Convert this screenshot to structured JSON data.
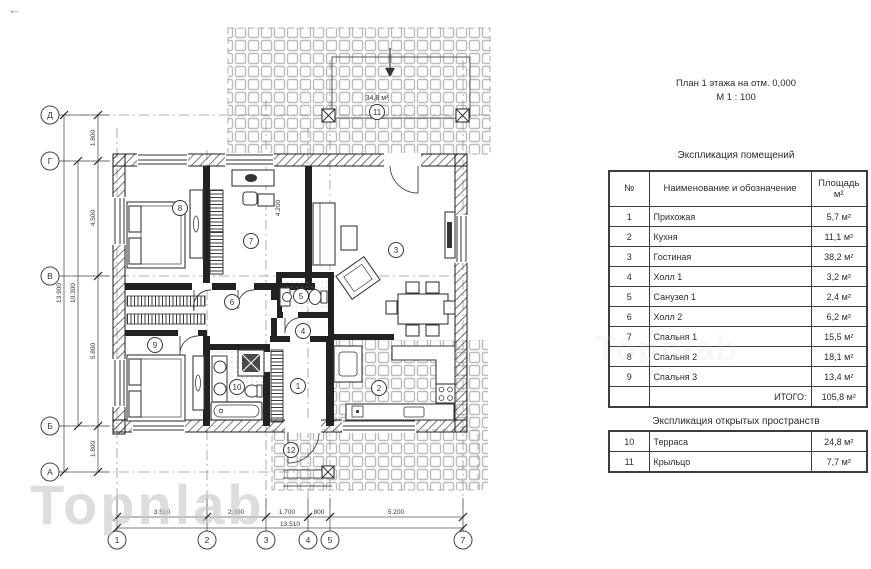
{
  "header": {
    "back_glyph": "←"
  },
  "watermark": {
    "text": "Topnlab"
  },
  "plan": {
    "title": "План 1 этажа на отм. 0,000",
    "scale": "М 1 : 100",
    "terrace_area": "34,8 м²",
    "axis_rows": [
      "Д",
      "Г",
      "В",
      "Б",
      "А"
    ],
    "axis_cols": [
      "1",
      "2",
      "3",
      "4",
      "5",
      "7"
    ],
    "dims_left": [
      "1.800",
      "4.500",
      "5.800",
      "1.800"
    ],
    "dim_left_total": "13.900",
    "dim_left_inner": "10.300",
    "dims_bottom": [
      "3.510",
      "2.300",
      "1.700",
      "800",
      "5.200"
    ],
    "dim_bottom_total": "13.510",
    "dim_interior": "4.200",
    "rooms": {
      "hallway": "1",
      "kitchen": "2",
      "living": "3",
      "hall1": "4",
      "wc1": "5",
      "hall2": "6",
      "bedroom1": "7",
      "bedroom2": "8",
      "bedroom3": "9",
      "bathroom2": "10",
      "terrace": "11",
      "porch": "12"
    }
  },
  "schedule": {
    "title": "Экспликация помещений",
    "col_num": "№",
    "col_name": "Наименование и обозначение",
    "col_area_line1": "Площадь",
    "col_area_line2": "м²",
    "rows": [
      {
        "num": "1",
        "name": "Прихожая",
        "area": "5,7 м²"
      },
      {
        "num": "2",
        "name": "Кухня",
        "area": "11,1 м²"
      },
      {
        "num": "3",
        "name": "Гостиная",
        "area": "38,2 м²"
      },
      {
        "num": "4",
        "name": "Холл 1",
        "area": "3,2 м²"
      },
      {
        "num": "5",
        "name": "Санузел 1",
        "area": "2,4 м²"
      },
      {
        "num": "6",
        "name": "Холл 2",
        "area": "6,2 м²"
      },
      {
        "num": "7",
        "name": "Спальня 1",
        "area": "15,5 м²"
      },
      {
        "num": "8",
        "name": "Спальня 2",
        "area": "18,1 м²"
      },
      {
        "num": "9",
        "name": "Спальня 3",
        "area": "13,4 м²"
      }
    ],
    "total_label": "ИТОГО:",
    "total_value": "105,8 м²"
  },
  "open_schedule": {
    "title": "Экспликация открытых пространств",
    "rows": [
      {
        "num": "10",
        "name": "Терраса",
        "area": "24,8 м²"
      },
      {
        "num": "11",
        "name": "Крыльцо",
        "area": "7,7 м²"
      }
    ]
  }
}
